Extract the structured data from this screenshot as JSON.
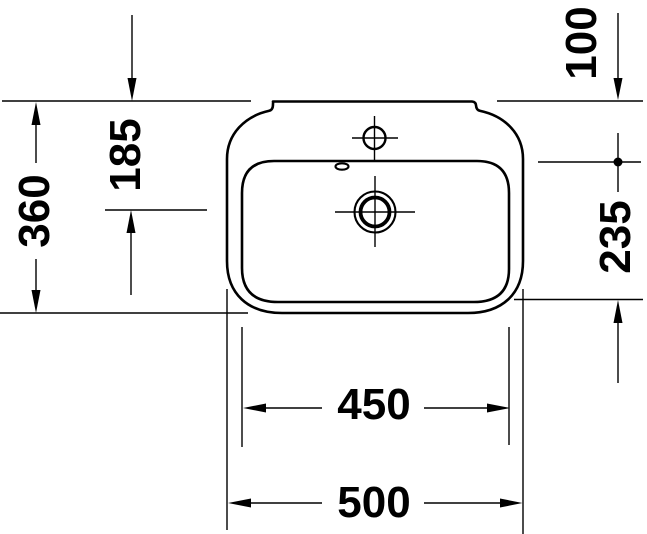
{
  "drawing": {
    "description": "washbasin-top-view-dimension-drawing",
    "background_color": "#ffffff",
    "line_color": "#000000",
    "labels": {
      "overall_depth": "360",
      "drain_center_depth": "185",
      "rim_to_basin_top": "100",
      "basin_depth": "235",
      "basin_width": "450",
      "overall_width": "500"
    }
  }
}
